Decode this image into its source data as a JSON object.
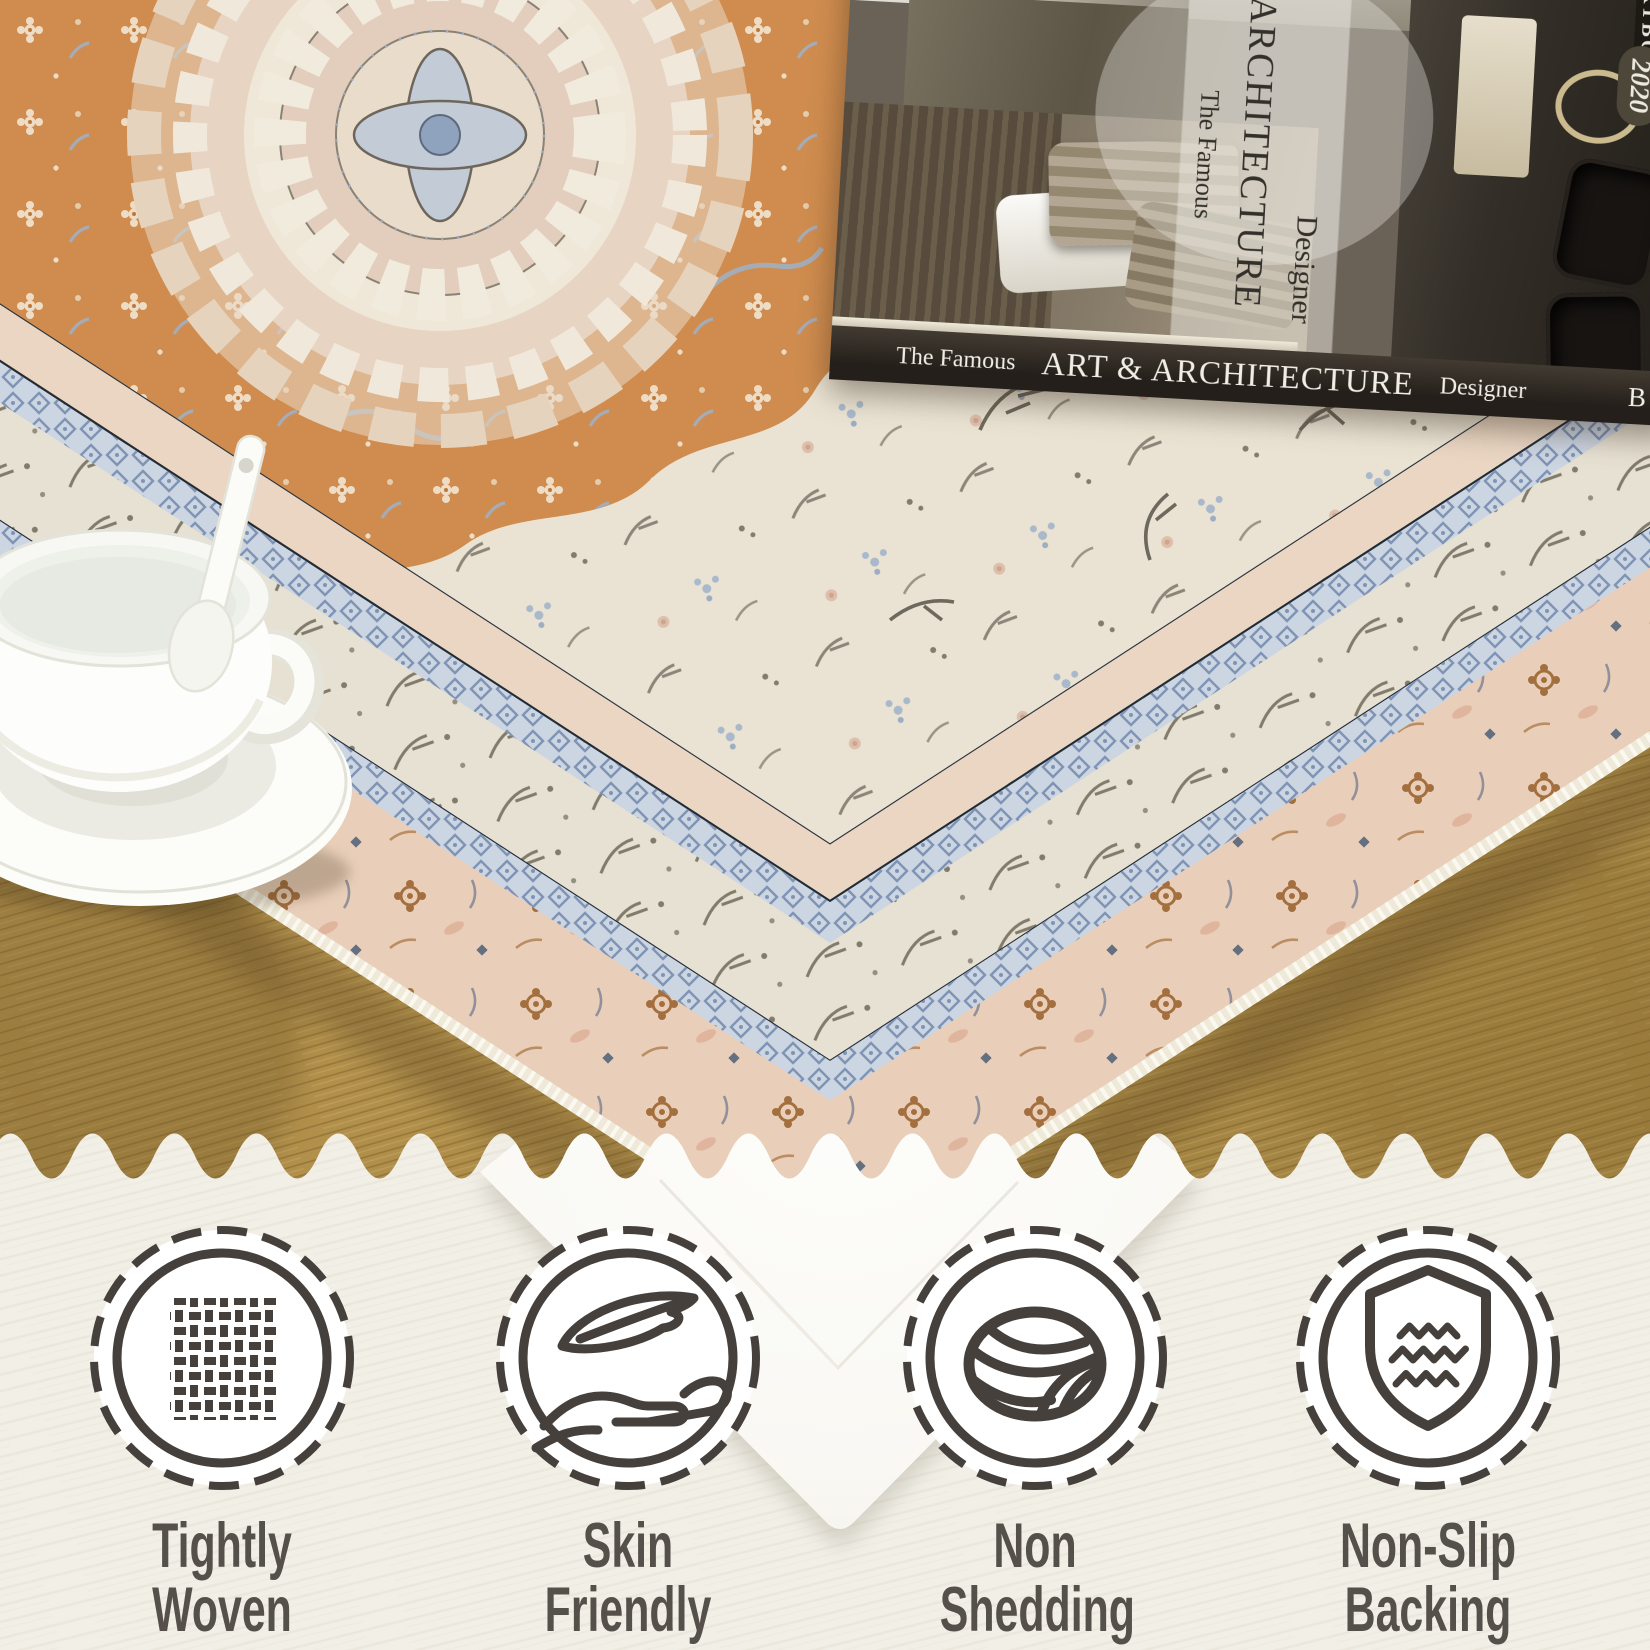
{
  "page": {
    "type": "rug-product-listing-image",
    "band_background": "#f2efe7"
  },
  "photo": {
    "book": {
      "tagline": "The Famous",
      "title": "ART & ARCHITECTURE",
      "subtitle": "Designer",
      "year": "2020",
      "publisher": "BLBGHS",
      "corner_text": "ARTBOOKS",
      "divider_icon": "diamond-ornament-icon"
    },
    "objects": {
      "rug": "persian-medallion-area-rug",
      "cup": "white-teacup-with-saucer-and-spoon",
      "floor": "wood-floor",
      "backing": "rug-nonslip-backing-corner"
    },
    "colors": {
      "rug_orange": "#cf8c4e",
      "rug_cream": "#eae3d3",
      "rug_blush_border": "#e9cfba",
      "rug_blue_band": "#ccd5e2",
      "rug_navy_line": "#222c36",
      "wood": "#b3914c",
      "backing_white": "#fbfaf6"
    }
  },
  "features": {
    "icon_color": "#45403c",
    "label_color": "#56504a",
    "items": [
      {
        "icon": "tightly-woven-icon",
        "lines": [
          "Tightly",
          "Woven"
        ]
      },
      {
        "icon": "skin-friendly-icon",
        "lines": [
          "Skin",
          "Friendly"
        ]
      },
      {
        "icon": "non-shedding-icon",
        "lines": [
          "Non",
          "Shedding"
        ]
      },
      {
        "icon": "non-slip-backing-icon",
        "lines": [
          "Non-Slip",
          "Backing"
        ]
      }
    ]
  }
}
